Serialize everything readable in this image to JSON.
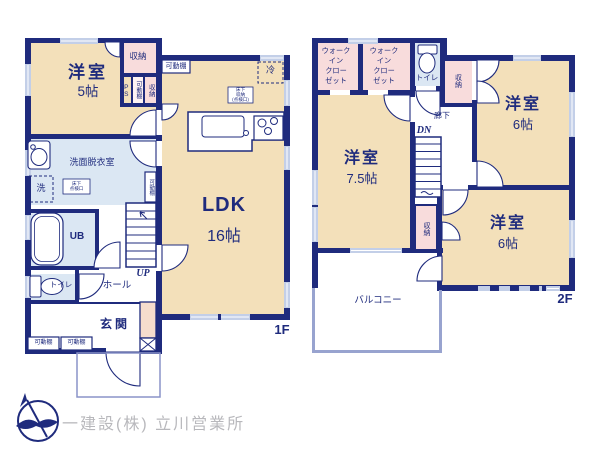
{
  "floor1": {
    "floor_label": "1F",
    "western_room": {
      "name": "洋室",
      "size": "5帖"
    },
    "ldk": {
      "name": "LDK",
      "size": "16帖"
    },
    "washroom": "洗面脱衣室",
    "unit_bath": "UB",
    "toilet": "トイレ",
    "hall": "ホール",
    "entrance": "玄関",
    "stairs_up": "UP",
    "storage": "収納",
    "pipe_space": "PS",
    "movable_shelf": "可動棚",
    "refrigerator": "冷",
    "washer": "洗",
    "underfloor_storage": {
      "l1": "床下",
      "l2": "収納",
      "l3": "(点検口)"
    },
    "underfloor_hatch": {
      "l1": "床下",
      "l2": "点検口"
    }
  },
  "floor2": {
    "floor_label": "2F",
    "wic": {
      "l1": "ウォーク",
      "l2": "イン",
      "l3": "クロー",
      "l4": "ゼット"
    },
    "toilet": "トイレ",
    "storage": "収納",
    "corridor": "廊下",
    "stairs_down": "DN",
    "western_room_right_top": {
      "name": "洋室",
      "size": "6帖"
    },
    "western_room_left": {
      "name": "洋室",
      "size": "7.5帖"
    },
    "western_room_right_bottom": {
      "name": "洋室",
      "size": "6帖"
    },
    "balcony": "バルコニー"
  },
  "footer": {
    "company": "一建設(株) 立川営業所"
  },
  "colors": {
    "wall": "#1f2b7d",
    "room": "#f3e0ba",
    "closet": "#f8dcdc",
    "wet_area": "#dbe7f3",
    "window": "#c3cfe8",
    "entrance_storage": "#f6dccd",
    "balcony_rail": "#98a3cf",
    "company_text": "#b8b8bc"
  }
}
